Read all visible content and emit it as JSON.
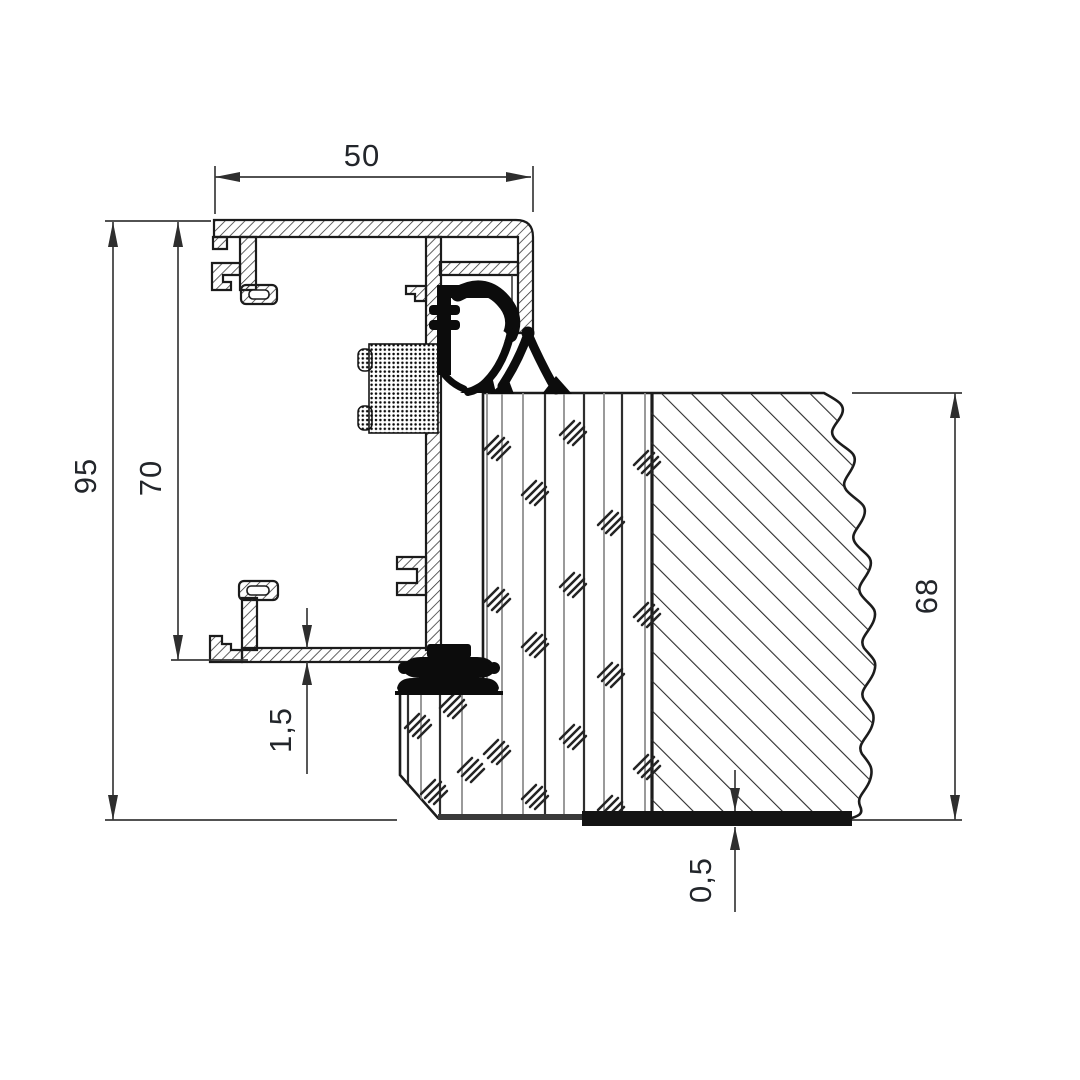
{
  "drawing": {
    "type": "technical_section_drawing",
    "description": "Aluminium frame and door leaf threshold cross-section",
    "background": "#ffffff",
    "line_color": "#1b1b1b",
    "dim_line_color": "#3a3a3a",
    "text_color": "#23262b",
    "gasket_color": "#0c0c0c",
    "dimensions": {
      "top_width": {
        "label": "50",
        "orientation": "horizontal"
      },
      "overall_height": {
        "label": "95",
        "orientation": "vertical"
      },
      "frame_height": {
        "label": "70",
        "orientation": "vertical"
      },
      "flange_thickness": {
        "label": "1,5",
        "orientation": "vertical"
      },
      "leaf_thickness": {
        "label": "68",
        "orientation": "vertical"
      },
      "bottom_sheet_thickness": {
        "label": "0,5",
        "orientation": "vertical"
      }
    }
  }
}
